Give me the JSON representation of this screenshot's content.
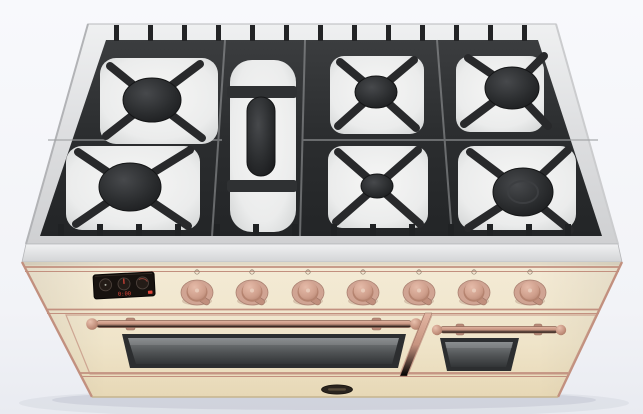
{
  "scene": {
    "subject": "Freestanding dual-fuel range cooker",
    "finish": "antique cream enamel with copper accents",
    "view": "front three-quarter view from above",
    "background": "plain white studio backdrop"
  },
  "colors": {
    "background_top": "#f8f9fc",
    "background_bottom": "#eaecf2",
    "steel_rim": "#dcdddf",
    "grate": "#2b2d2f",
    "enamel_bowl": "#f0f1f0",
    "burner_cap": "#202224",
    "body_cream": "#f2e9d3",
    "copper_trim": "#c2907f",
    "knob_copper": "#d0a493",
    "display_bg": "#17120f",
    "display_red": "#e0463a",
    "glass": "#54585a",
    "badge": "#2a241e"
  },
  "cooktop": {
    "grate_material": "matte black cast iron",
    "surface_material": "stainless steel with white enamel burner bowls",
    "burner_count": 7,
    "burners": [
      {
        "id": "rear-left",
        "type": "round",
        "size": "medium"
      },
      {
        "id": "front-left",
        "type": "round",
        "size": "large"
      },
      {
        "id": "center",
        "type": "oval",
        "size": "elongated fish burner"
      },
      {
        "id": "rear-center",
        "type": "round",
        "size": "medium"
      },
      {
        "id": "front-center",
        "type": "round",
        "size": "small"
      },
      {
        "id": "rear-right",
        "type": "round",
        "size": "medium"
      },
      {
        "id": "front-right",
        "type": "round",
        "size": "large wok"
      }
    ]
  },
  "control_panel": {
    "display": {
      "type": "digital clock-timer with dial graphics",
      "value": "0:00",
      "accent_color": "#e0463a"
    },
    "knob_count": 7,
    "knob_finish": "antique copper",
    "knobs": [
      {
        "id": "knob-1"
      },
      {
        "id": "knob-2"
      },
      {
        "id": "knob-3"
      },
      {
        "id": "knob-4"
      },
      {
        "id": "knob-5"
      },
      {
        "id": "knob-6"
      },
      {
        "id": "knob-7"
      }
    ]
  },
  "ovens": {
    "main_door": {
      "handle": "copper towel-bar handle",
      "window": "smoked glass"
    },
    "side_door": {
      "handle": "copper towel-bar handle",
      "window": "smoked glass"
    }
  },
  "badge": {
    "shape": "dark oval nameplate",
    "position": "bottom center"
  }
}
